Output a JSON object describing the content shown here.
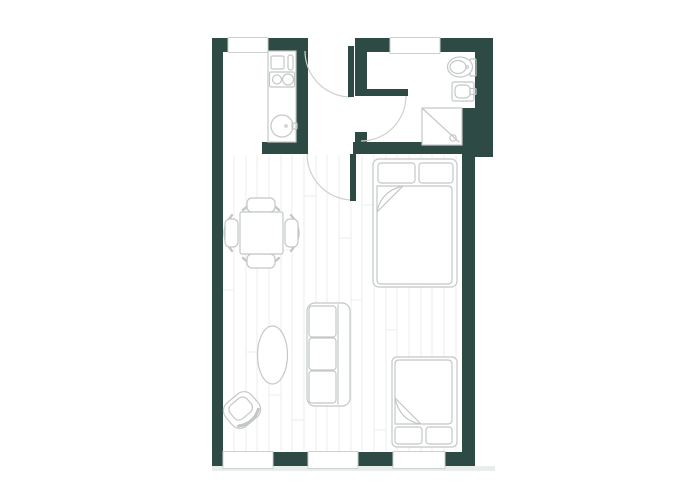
{
  "plan": {
    "kind": "apartment-floor-plan",
    "rooms": {
      "kitchen": {
        "name": "kitchen",
        "fixtures": [
          "counter",
          "appliance",
          "cutting-board",
          "cooktop-two-burners",
          "round-sink"
        ]
      },
      "bathroom": {
        "name": "bathroom",
        "fixtures": [
          "toilet",
          "washbasin",
          "shower"
        ]
      },
      "hallway": {
        "name": "hallway",
        "doors": [
          "entrance-door",
          "bathroom-door",
          "living-room-door"
        ]
      },
      "living_room": {
        "name": "living-room",
        "furniture": [
          "dining-table",
          "chair-top",
          "chair-bottom",
          "chair-left",
          "chair-right",
          "double-bed",
          "second-bed",
          "sofa-three-seat",
          "oval-rug",
          "armchair"
        ]
      }
    },
    "windows": {
      "top_wall": 2,
      "bottom_wall": 3
    }
  },
  "colors": {
    "background": "#ffffff",
    "wall": "#2e4a45",
    "door_leaf": "#2e4a45",
    "door_arc": "#cfd0ca",
    "furniture_line": "#c3c8c7",
    "furniture_fill": "#ffffff",
    "floor_line": "#ededec",
    "window_frame": "#ccd2d0",
    "shadow": "#e9edec"
  }
}
